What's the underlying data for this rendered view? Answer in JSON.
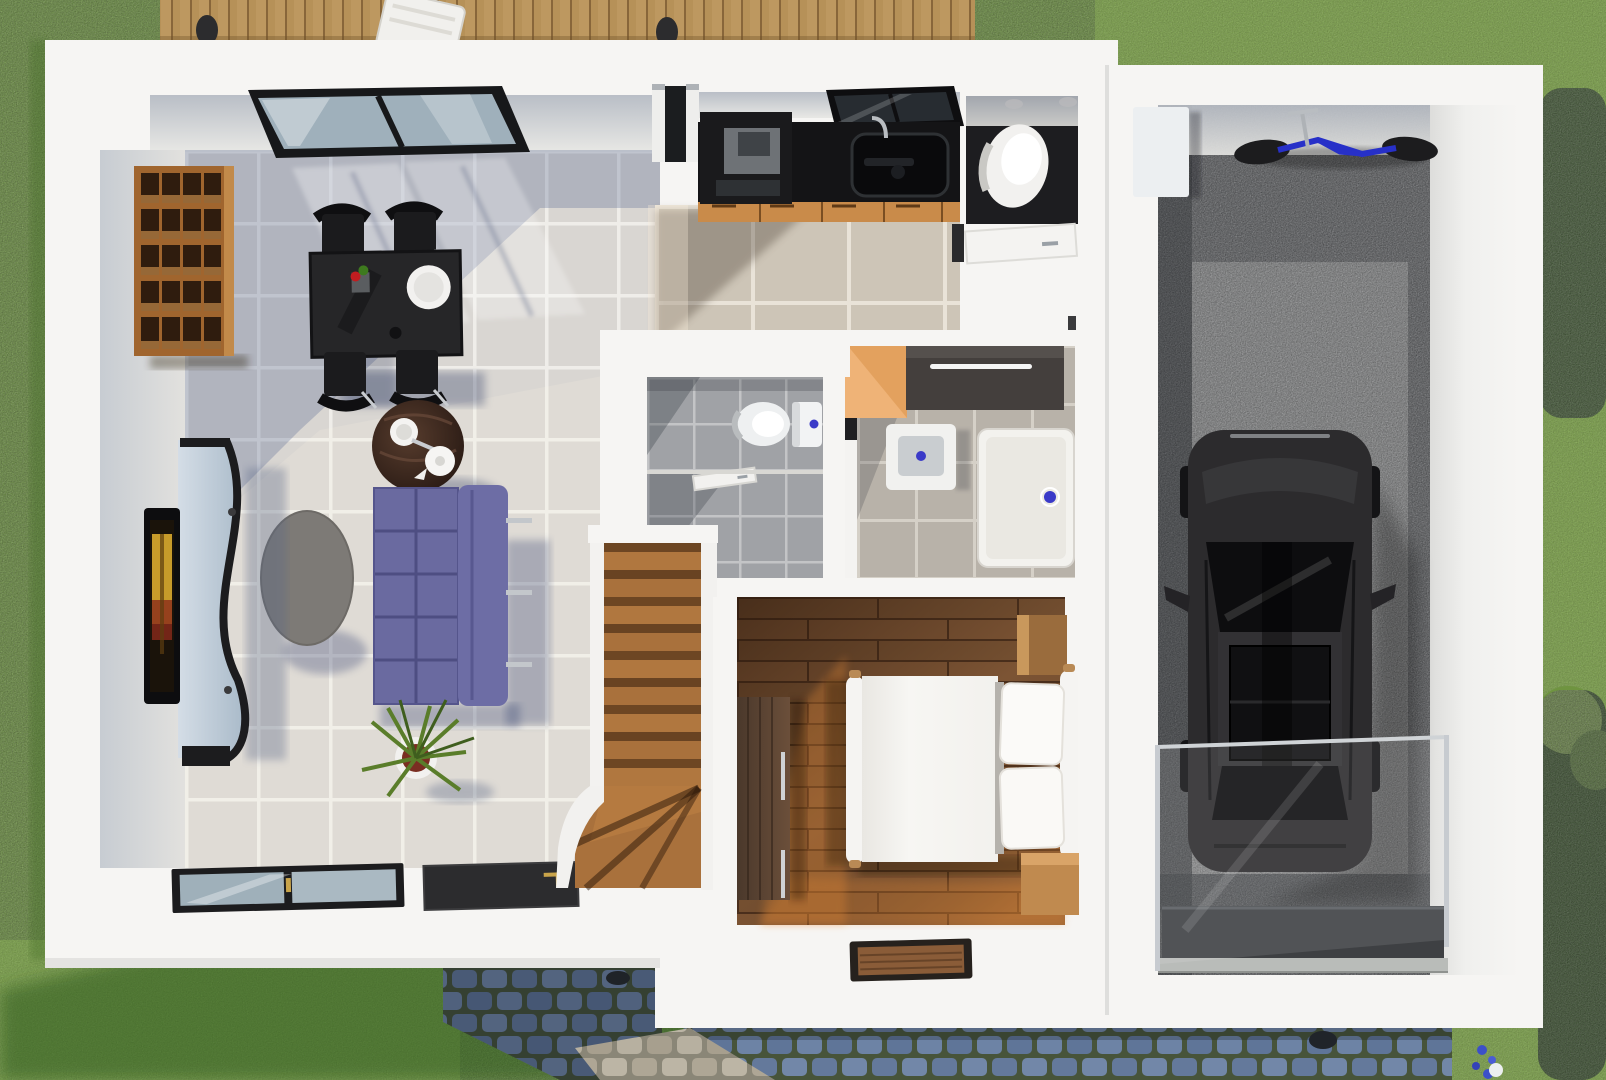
{
  "scene": {
    "type": "architectural-3d-floorplan-render",
    "view": "top-down",
    "width_px": 1606,
    "height_px": 1080,
    "visible_text": "none"
  },
  "palette": {
    "grass_base": "#7aab41",
    "grass_light": "#92c255",
    "grass_shadow": "#3f6b22",
    "deck_wood": "#bf995e",
    "house_white": "#f6f5f3",
    "wall_face_gray": "#c3c8cf",
    "tile_living": "#d9d6d2",
    "tile_grout": "#efede9",
    "tile_shadow_blue": "#5d6d95",
    "tile_hall_beige": "#cdc5b7",
    "tile_bath_gray": "#a0a2a6",
    "tile_bath_warm": "#b8b2a9",
    "wc_floor_dark": "#1d1d20",
    "counter_black": "#141416",
    "cabinet_drawer_orange": "#c98b4a",
    "cabinet_tall_orange": "#efb377",
    "dresser_dark": "#443f3d",
    "sofa_purple": "#6a6aa0",
    "coffee_table_wood": "#3a2a21",
    "bookshelf_wood": "#a0652e",
    "stair_wood": "#a9713c",
    "bedroom_floor_dark": "#7c5434",
    "bedroom_floor_sun": "#c07f43",
    "wardrobe_wood": "#55402f",
    "bed_white": "#f7f6f3",
    "gravel_dark": "#54575c",
    "gravel_sun": "#a9abac",
    "car_black": "#2c2b2d",
    "bike_blue": "#2730c8",
    "cobble_blue": "#7287a8",
    "cobble_moss": "#47543a",
    "cobble_light": "#b7b0a0",
    "drain_blue": "#3a3ac8",
    "tv_screen_amber": "#c79b2a"
  },
  "house": {
    "rooms": [
      {
        "name": "living-dining-room",
        "floor": "light gray tiles",
        "objects": [
          "skylight",
          "bookshelf",
          "dining-table",
          "dining-chairs-x4",
          "dinner-plate",
          "table-plant",
          "coffee-table",
          "tea-set",
          "purple-sofa",
          "oval-side-table",
          "tv-wall-unit",
          "wall-tv",
          "potted-plant",
          "sliding-glass-door",
          "dark-entry-panel"
        ]
      },
      {
        "name": "kitchen",
        "objects": [
          "black-countertop",
          "cooktop-appliance",
          "kitchen-sink",
          "faucet",
          "drawer-row",
          "kitchen-window",
          "deck-door"
        ]
      },
      {
        "name": "wc-top",
        "objects": [
          "toilet",
          "door",
          "ceiling-spots"
        ]
      },
      {
        "name": "wc-middle",
        "objects": [
          "toilet",
          "wall-niche",
          "door"
        ]
      },
      {
        "name": "shower-bathroom",
        "objects": [
          "orange-cabinet",
          "dark-dresser",
          "washbasin",
          "shower-tray",
          "door-opening"
        ]
      },
      {
        "name": "staircase",
        "objects": [
          "straight-treads-x9",
          "winder-steps",
          "white-stringers"
        ]
      },
      {
        "name": "bedroom",
        "objects": [
          "double-bed",
          "pillows-x2",
          "nightstand-top",
          "nightstand-bottom",
          "wardrobe",
          "doormat"
        ]
      }
    ]
  },
  "garage": {
    "floor": "gravel",
    "objects": [
      "black-car",
      "blue-bicycle",
      "storage-block",
      "glass-screen",
      "garage-mat",
      "threshold-sill"
    ]
  },
  "exterior": {
    "objects": [
      "lawn",
      "wood-deck",
      "deck-chair",
      "deck-bollards",
      "cobble-path-entry",
      "cobble-path-street",
      "drain-cover-x2",
      "hedge-top-right",
      "hedge-bottom-right",
      "blue-flowers",
      "white-garden-ball",
      "house-shadow"
    ]
  }
}
